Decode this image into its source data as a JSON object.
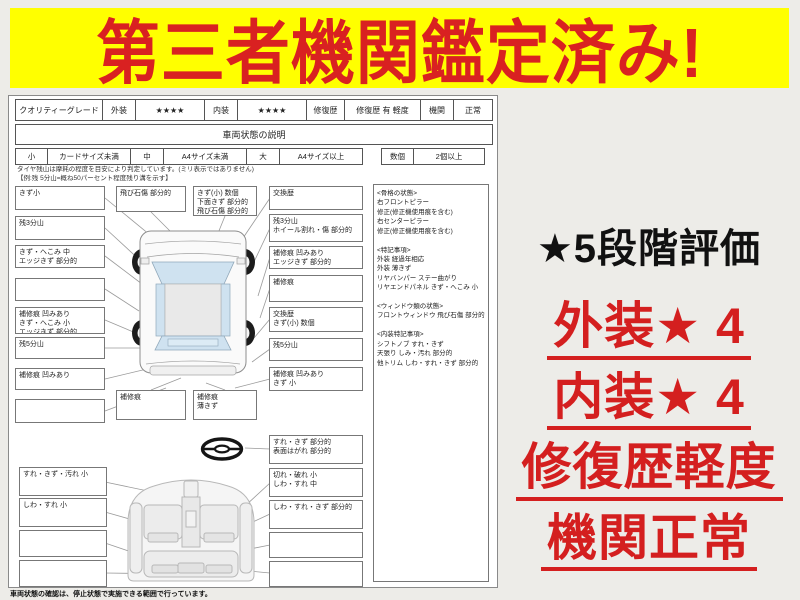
{
  "banner": {
    "text": "第三者機関鑑定済み!",
    "bg_color": "#ffff00",
    "text_color": "#d92121"
  },
  "report": {
    "grade_row": {
      "quality_label": "クオリティーグレード",
      "exterior_label": "外装",
      "exterior_stars": "★★★★",
      "interior_label": "内装",
      "interior_stars": "★★★★",
      "repair_label": "修復歴",
      "repair_value": "修復歴 有 軽度",
      "engine_label": "機関",
      "engine_value": "正常"
    },
    "section_title": "車両状態の説明",
    "size_row": {
      "small_label": "小",
      "small_value": "カードサイズ未満",
      "mid_label": "中",
      "mid_value": "A4サイズ未満",
      "large_label": "大",
      "large_value": "A4サイズ以上",
      "count_label": "数個",
      "count_value": "2個以上"
    },
    "notes": {
      "line1": "タイヤ残山は摩耗の程度を目安により判定しています。(ミリ表示ではありません)",
      "line2": "【例:残 5分山=概ね50パーセント程度残り溝を示す】"
    },
    "exterior": {
      "left_boxes": [
        "きず小",
        "残3分山",
        "きず・へこみ 中\nエッジきず 部分的",
        "",
        "補修痕 凹みあり\nきず・へこみ 小\nエッジきず 部分的",
        "残5分山",
        "補修痕 凹みあり",
        ""
      ],
      "top_boxes": [
        "飛び石傷 部分的",
        "きず(小) 数個\n下面きず 部分的\n飛び石傷 部分的"
      ],
      "right_boxes": [
        "交換歴",
        "残3分山\nホイール割れ・傷 部分的",
        "補修痕 凹みあり\nエッジきず 部分的",
        "補修痕",
        "交換歴\nきず(小) 数個",
        "残5分山",
        "補修痕 凹みあり\nきず 小"
      ],
      "bottom_boxes": [
        "補修痕",
        "補修痕\n薄きず"
      ]
    },
    "remarks": "<骨格の状態>\n右フロントピラー\n修正(修正機使用痕を含む)\n右センターピラー\n修正(修正機使用痕を含む)\n\n<特記事項>\n外装 経過年相応\n外装 薄きず\nリヤバンパー ステー曲がり\nリヤエンドパネル きず・へこみ 小\n\n<ウィンドウ類の状態>\nフロントウィンドウ 飛び石傷 部分的\n\n<内装特記事項>\nシフトノブ すれ・きず\n天張り しみ・汚れ 部分的\n他トリム しわ・すれ・きず 部分的",
    "interior": {
      "steering_box": "すれ・きず 部分的\n表面はがれ 部分的",
      "left_boxes": [
        "すれ・きず・汚れ 小",
        "しわ・すれ 小",
        "",
        ""
      ],
      "right_boxes": [
        "切れ・破れ 小\nしわ・すれ 中",
        "しわ・すれ・きず 部分的",
        "",
        ""
      ]
    },
    "footer": "車両状態の確認は、停止状態で実施できる範囲で行っています。"
  },
  "annotations": {
    "rating_title": "★5段階評価",
    "items": [
      "外装★ 4",
      "内装★ 4",
      "修復歴軽度",
      "機関正常"
    ],
    "red_color": "#d41f1f"
  }
}
